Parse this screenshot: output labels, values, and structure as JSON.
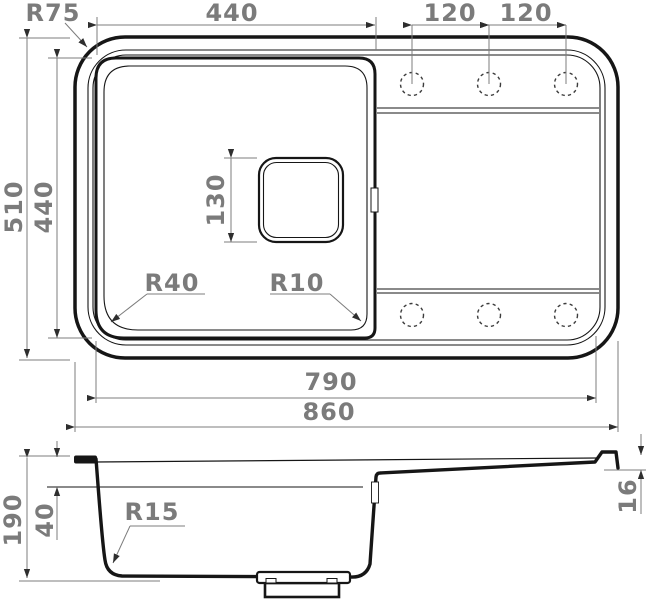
{
  "drawing": {
    "colors": {
      "background": "#ffffff",
      "object_line": "#161616",
      "dimension_line": "#7c7c7c",
      "dimension_text": "#7b7b7b",
      "arrowhead": "#2e2e2e"
    },
    "top_view": {
      "dims": {
        "corner_radius": "R75",
        "bowl_width": "440",
        "faucet_hole_spacing_left": "120",
        "faucet_hole_spacing_right": "120",
        "overall_depth": "510",
        "bowl_depth": "440",
        "drain_size": "130",
        "bowl_corner_radius_left": "R40",
        "bowl_corner_radius_right": "R10",
        "inner_length": "790",
        "overall_length": "860"
      }
    },
    "side_view": {
      "dims": {
        "overall_height": "190",
        "rim_height": "40",
        "bottom_corner_radius": "R15",
        "edge_thickness": "16"
      }
    }
  }
}
